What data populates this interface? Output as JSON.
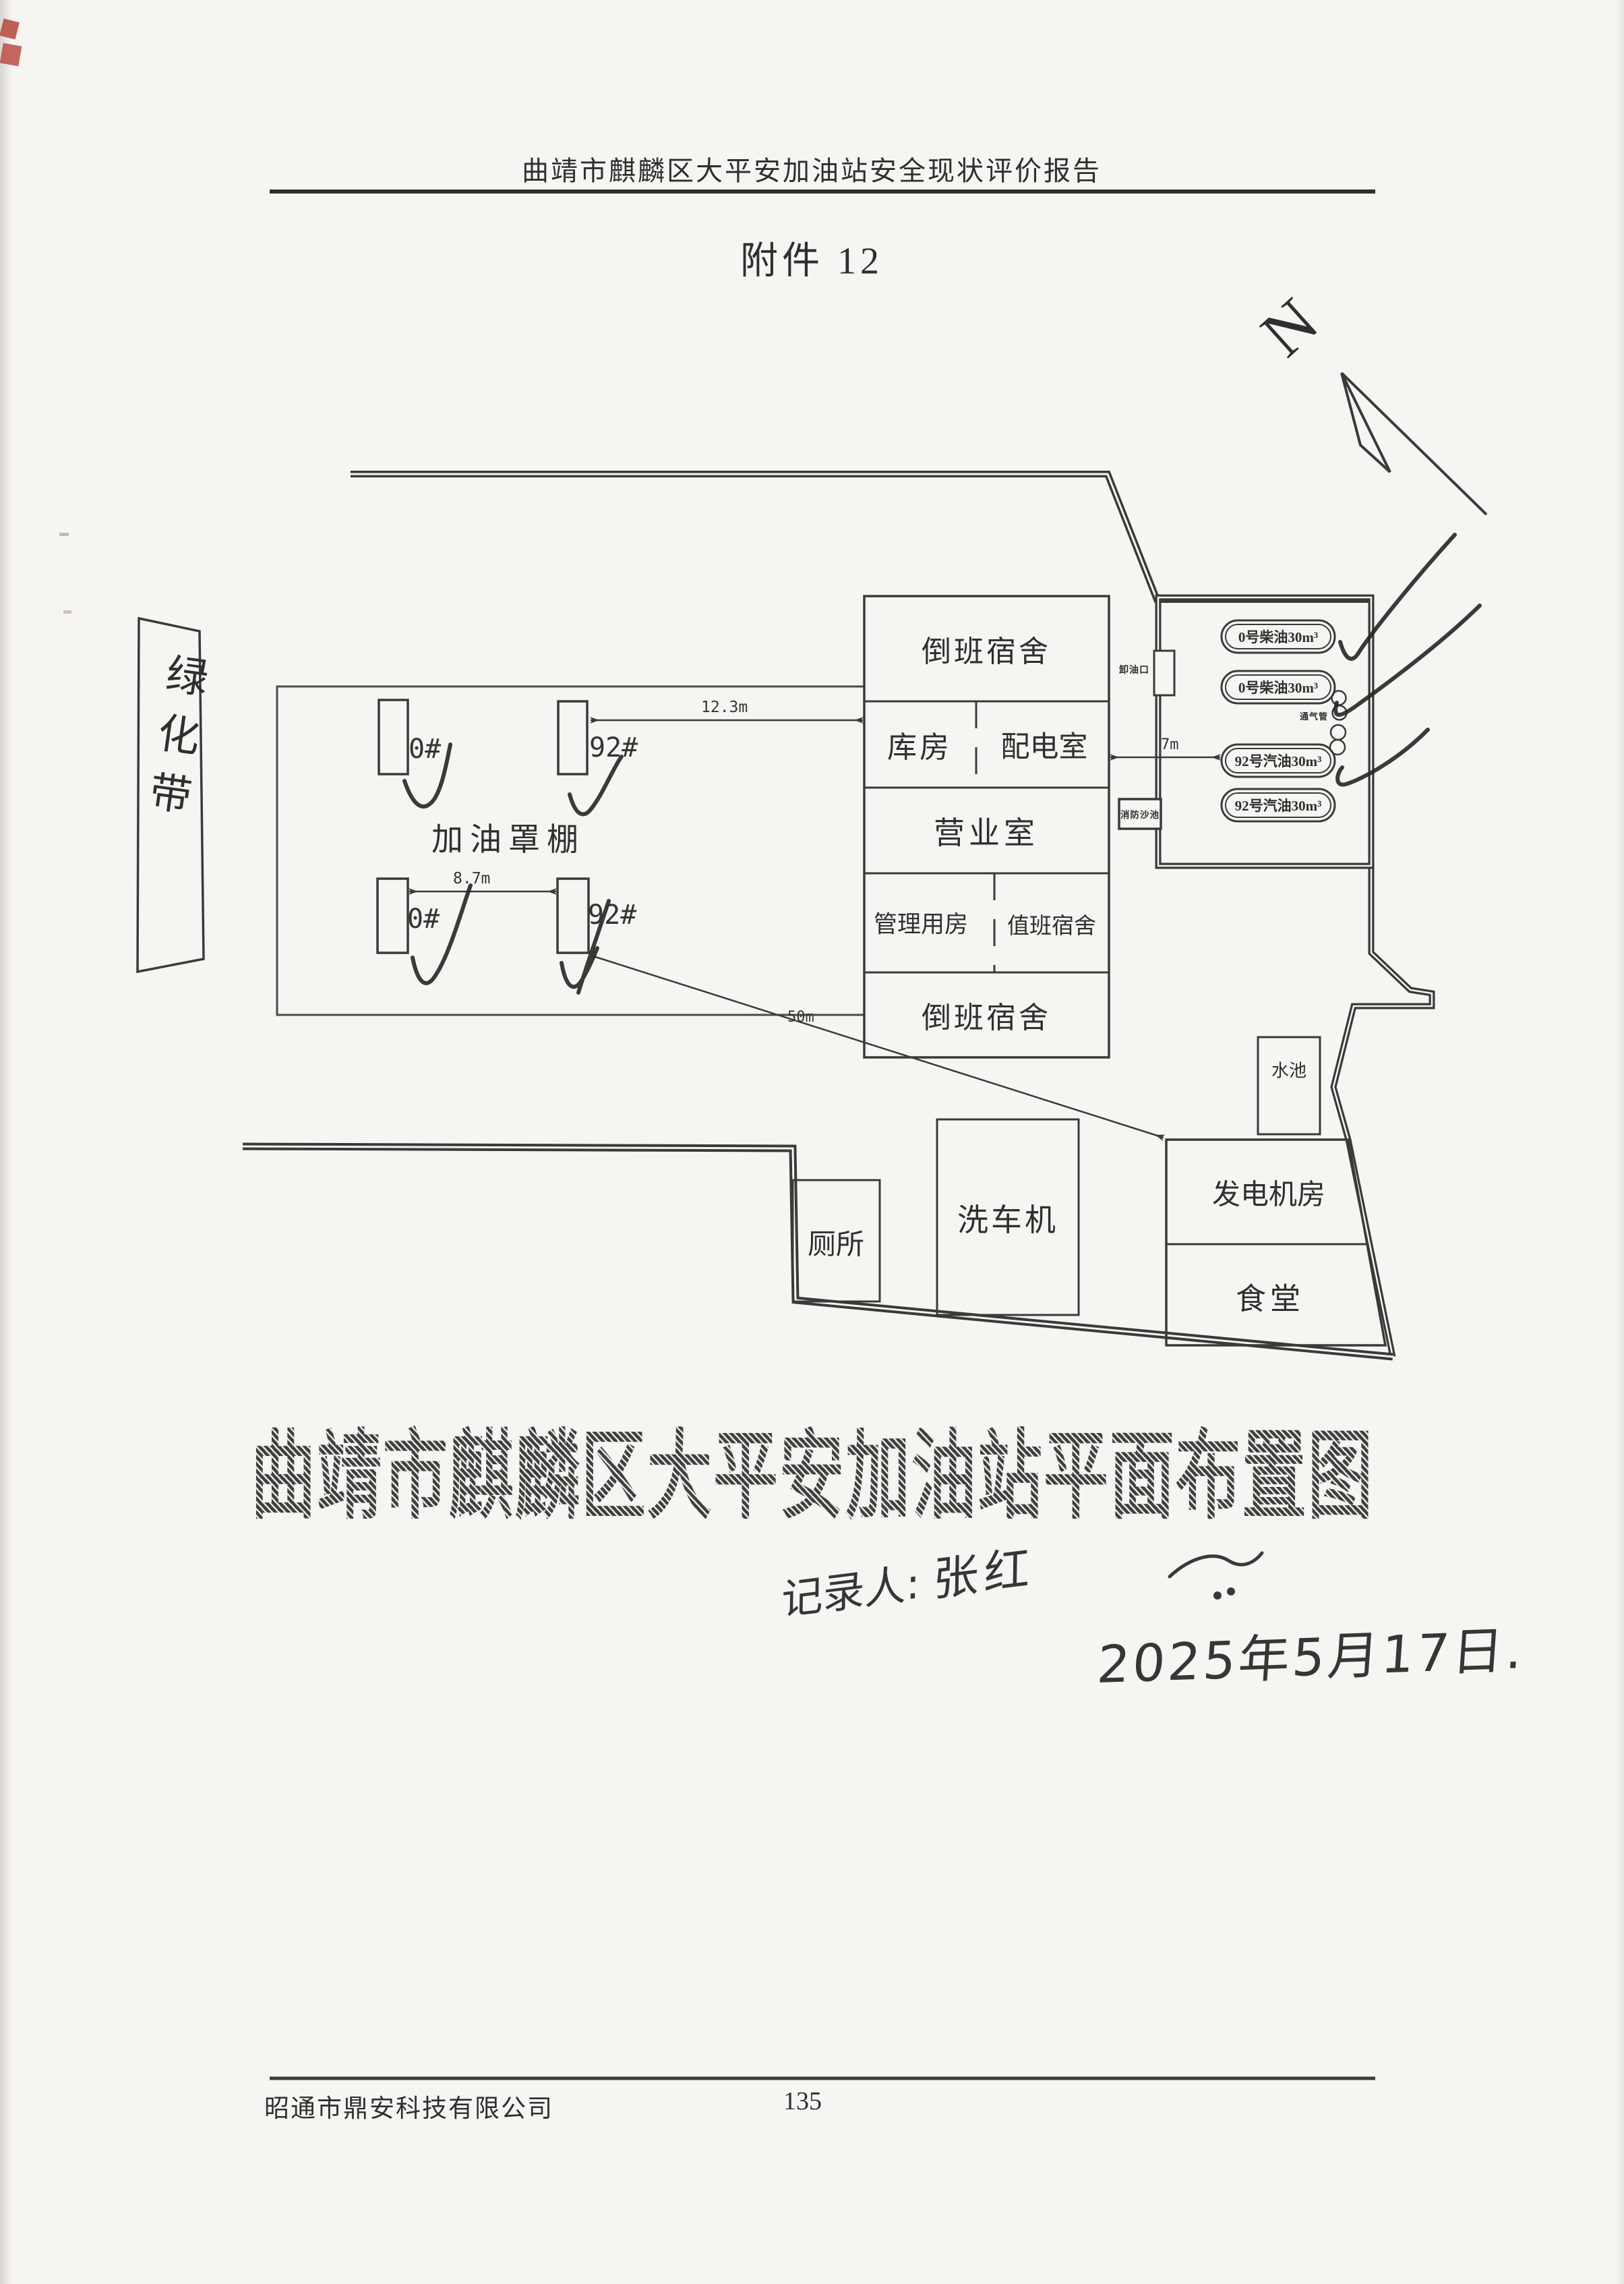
{
  "page": {
    "bg": "#f6f5f2",
    "ink": "#3a3a3a",
    "pen": "#262626",
    "red": "#b8443a"
  },
  "header": {
    "report_title": "曲靖市麒麟区大平安加油站安全现状评价报告",
    "attachment_label": "附件 12"
  },
  "compass": {
    "letter": "N"
  },
  "site": {
    "green_belt": "绿化带",
    "canopy": "加油罩棚",
    "dispensers": [
      "0#",
      "92#",
      "0#",
      "92#"
    ],
    "rooms": {
      "dorm_top": "倒班宿舍",
      "warehouse": "库房",
      "power_room": "配电室",
      "sales_room": "营业室",
      "management_room": "管理用房",
      "duty_dorm": "值班宿舍",
      "dorm_bottom": "倒班宿舍"
    },
    "tanks": [
      "0号柴油30m³",
      "0号柴油30m³",
      "92号汽油30m³",
      "92号汽油30m³"
    ],
    "unload_port": "卸油口",
    "vent_pipe": "通气管",
    "fire_sand_pool": "消防沙池",
    "water_pool": "水池",
    "car_washer": "洗车机",
    "toilet": "厕所",
    "generator_room": "发电机房",
    "canteen": "食堂",
    "dims": {
      "canopy_to_building": "12.3m",
      "dispenser_gap": "8.7m",
      "building_to_tank": "7m",
      "to_generator": "50m"
    }
  },
  "caption": {
    "main_title": "曲靖市麒麟区大平安加油站平面布置图",
    "recorder_label": "记录人:",
    "recorder_name": "张红",
    "date": "2025年5月17日."
  },
  "footer": {
    "company": "昭通市鼎安科技有限公司",
    "page_number": "135"
  }
}
